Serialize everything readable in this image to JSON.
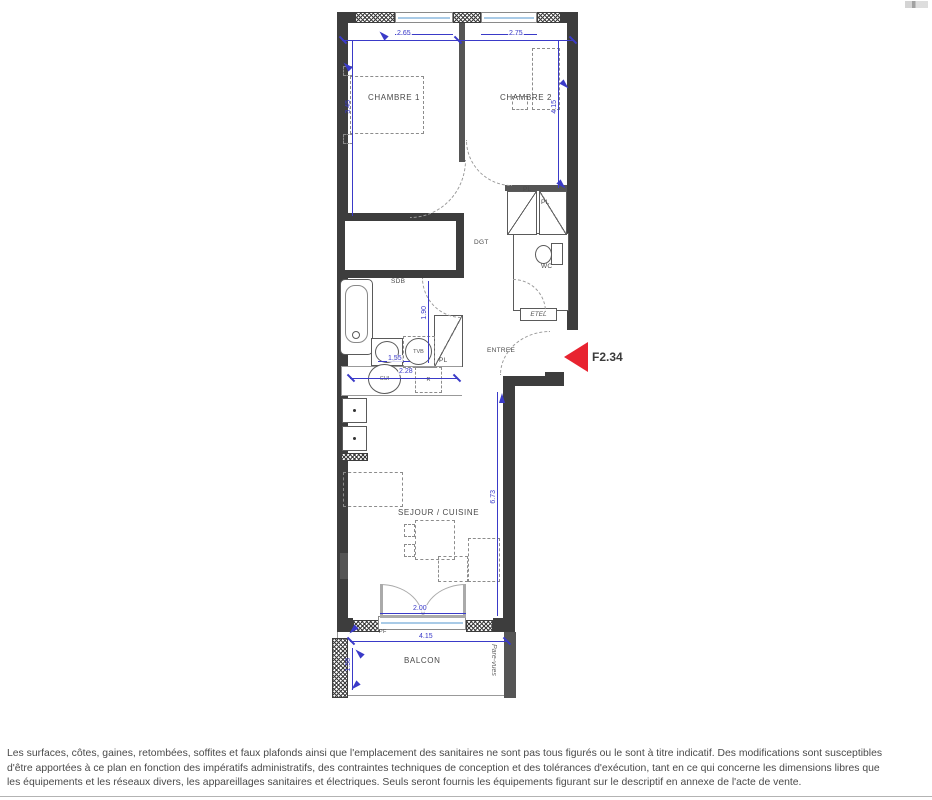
{
  "unit": {
    "ref": "F2.34"
  },
  "rooms": {
    "chambre1": "CHAMBRE 1",
    "chambre2": "CHAMBRE 2",
    "dgt": "DGT",
    "wc": "WC",
    "sdb": "SDB",
    "entree": "ENTREE",
    "sejour": "SEJOUR / CUISINE",
    "balcon": "BALCON",
    "etel": "ETEL",
    "pl": "PL",
    "pf": "PF",
    "pare_vues": "Pare-vues"
  },
  "fixtures": {
    "washer": "TVB",
    "sink": "CUI",
    "fridge": "R"
  },
  "dims": {
    "window1": "2.65",
    "window2": "2.75",
    "chambre1_depth": "3.45",
    "chambre2_depth": "4.15",
    "sdb_depth": "1.90",
    "lavabo_width": "1.55",
    "kitchen_width": "2.28",
    "sejour_depth": "6.73",
    "pf_width": "2.00",
    "balcon_width": "4.15",
    "balcon_depth": "1.58"
  },
  "colors": {
    "wall": "#3d3d3d",
    "dimension_blue": "#3a3ac8",
    "arrow_red": "#e82330",
    "label_gray": "#4a4a4a",
    "window_sill_blue": "#a9cbe7"
  },
  "disclaimer": {
    "line1": "Les surfaces, côtes, gaines, retombées, soffites et faux plafonds ainsi que l'emplacement des sanitaires ne sont pas tous figurés ou le sont à titre indicatif. Des modifications sont susceptibles",
    "line2": "d'être apportées à ce plan en fonction des impératifs administratifs, des contraintes techniques de conception et des tolérances d'exécution, tant en ce qui concerne les dimensions libres que",
    "line3": "les équipements et les réseaux divers, les appareillages sanitaires et électriques. Seuls seront fournis les équipements figurant sur le descriptif en annexe de l'acte de vente."
  }
}
